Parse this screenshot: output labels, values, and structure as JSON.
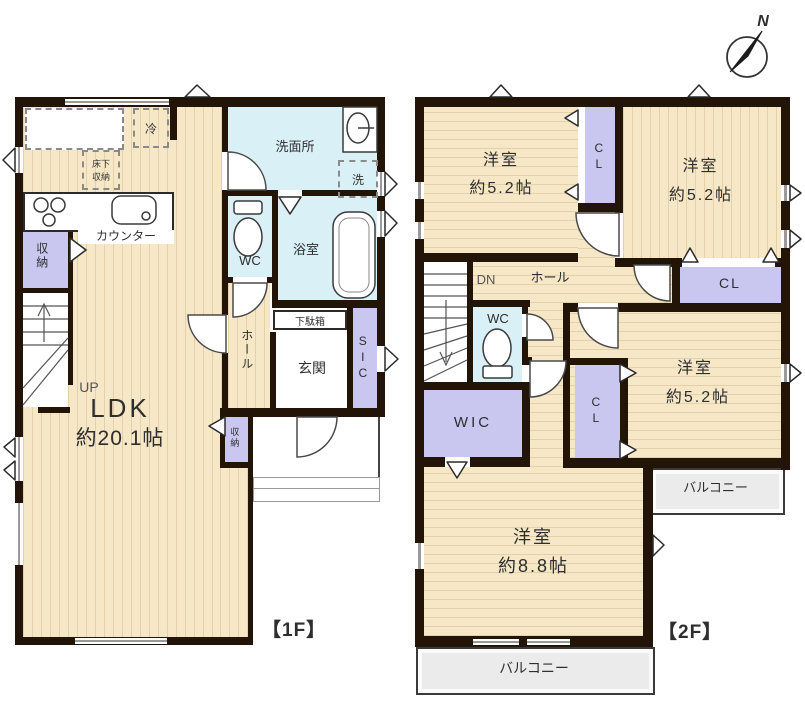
{
  "compass": {
    "north_label": "N"
  },
  "colors": {
    "floor_beige": "#f6e8c7",
    "wet_blue": "#d9f0f6",
    "storage_purple": "#c9c6ef",
    "wall_dark": "#221507",
    "balcony_gray": "#ebebeb"
  },
  "floor1": {
    "floor_label": "【1F】",
    "ldk": {
      "name": "LDK",
      "size": "約20.1帖"
    },
    "kitchen": {
      "fridge": "冷",
      "underfloor_storage": "床下収納",
      "counter": "カウンター"
    },
    "washroom": {
      "name": "洗面所",
      "washer": "洗"
    },
    "wc": "WC",
    "bath": "浴室",
    "hall": "ホール",
    "entrance": {
      "shoe_cabinet": "下駄箱",
      "name": "玄関",
      "sic": "SIC"
    },
    "storage_left": "収納",
    "storage_entry": "収納",
    "stairs_up": "UP"
  },
  "floor2": {
    "floor_label": "【2F】",
    "bedroom1": {
      "name": "洋室",
      "size": "約5.2帖"
    },
    "bedroom2": {
      "name": "洋室",
      "size": "約5.2帖"
    },
    "bedroom3": {
      "name": "洋室",
      "size": "約5.2帖"
    },
    "bedroom4": {
      "name": "洋室",
      "size": "約8.8帖"
    },
    "closet1": "CL",
    "closet2": "CL",
    "closet3": "CL",
    "hall": "ホール",
    "stairs_down": "DN",
    "wc": "WC",
    "wic": "WIC",
    "balcony_right": "バルコニー",
    "balcony_bottom": "バルコニー"
  }
}
